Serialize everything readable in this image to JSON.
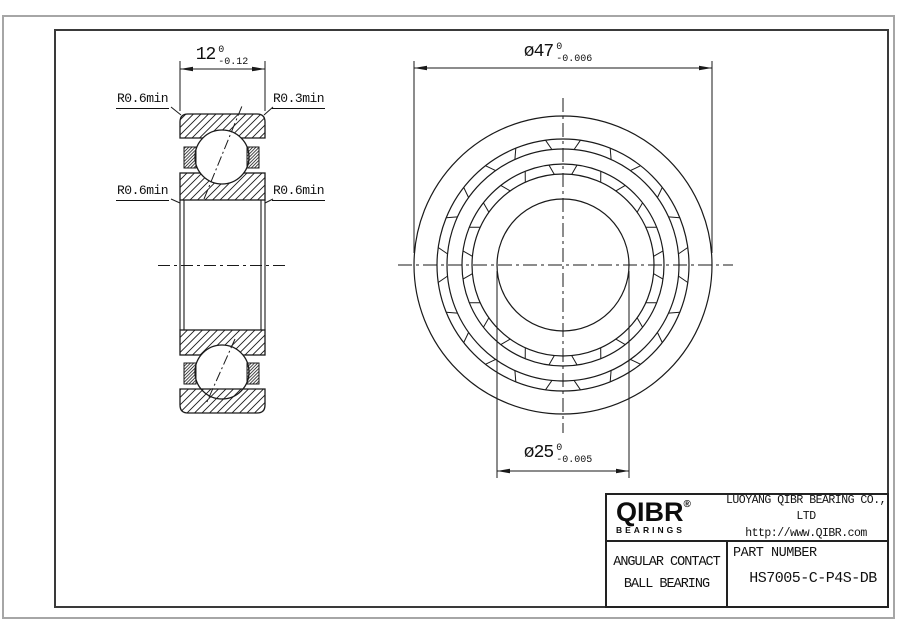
{
  "dimensions": {
    "width": {
      "value": "12",
      "tol_upper": "0",
      "tol_lower": "-0.12"
    },
    "outer_diameter": {
      "prefix": "ø",
      "value": "47",
      "tol_upper": "0",
      "tol_lower": "-0.006"
    },
    "bore_diameter": {
      "prefix": "ø",
      "value": "25",
      "tol_upper": "0",
      "tol_lower": "-0.005"
    }
  },
  "radius_labels": {
    "top_left": "R0.6min",
    "top_right": "R0.3min",
    "bottom_left": "R0.6min",
    "bottom_right": "R0.6min"
  },
  "title_block": {
    "brand": "QIBR",
    "registered_mark": "®",
    "brand_sub": "BEARINGS",
    "company": "LUOYANG QIBR BEARING CO., LTD",
    "website": "http://www.QIBR.com",
    "product_type_line1": "ANGULAR CONTACT",
    "product_type_line2": "BALL BEARING",
    "part_number_label": "PART NUMBER",
    "part_number": "HS7005-C-P4S-DB"
  },
  "colors": {
    "line": "#1a1a1a",
    "centerline": "#222222",
    "sheet_border": "#a6a6a6",
    "frame_border": "#3a3a3a",
    "background": "#ffffff"
  }
}
